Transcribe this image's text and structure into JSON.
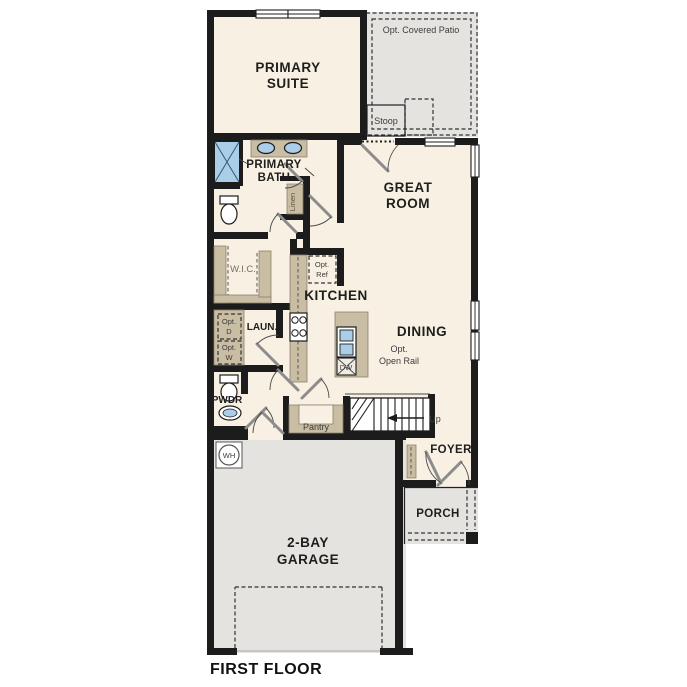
{
  "title": "FIRST FLOOR",
  "colors": {
    "wall": "#1c1c1c",
    "floor": "#f8f1e3",
    "hard_surface": "#e4e3e0",
    "counter_tan": "#c9bda3",
    "fixture_blue": "#aacde8"
  },
  "rooms": {
    "primary_suite": {
      "line1": "PRIMARY",
      "line2": "SUITE"
    },
    "primary_bath": {
      "line1": "PRIMARY",
      "line2": "BATH"
    },
    "great_room": {
      "line1": "GREAT",
      "line2": "ROOM"
    },
    "wic": {
      "label": "W.I.C."
    },
    "kitchen": {
      "label": "KITCHEN"
    },
    "dining": {
      "label": "DINING"
    },
    "laundry": {
      "label": "LAUN."
    },
    "powder": {
      "label": "PWDR"
    },
    "pantry": {
      "label": "Pantry"
    },
    "linen": {
      "label": "Linen"
    },
    "foyer": {
      "label": "FOYER"
    },
    "porch": {
      "label": "PORCH"
    },
    "garage": {
      "line1": "2-BAY",
      "line2": "GARAGE"
    },
    "stoop": {
      "label": "Stoop"
    },
    "patio": {
      "label": "Opt. Covered Patio"
    }
  },
  "annotations": {
    "opt_ref": {
      "line1": "Opt.",
      "line2": "Ref"
    },
    "opt_dryer": {
      "line1": "Opt.",
      "line2": "D"
    },
    "opt_washer": {
      "line1": "Opt.",
      "line2": "W"
    },
    "opt_open_rail": {
      "line1": "Opt.",
      "line2": "Open Rail"
    },
    "up": "Up",
    "dishwasher": "DW",
    "water_heater": "WH"
  }
}
